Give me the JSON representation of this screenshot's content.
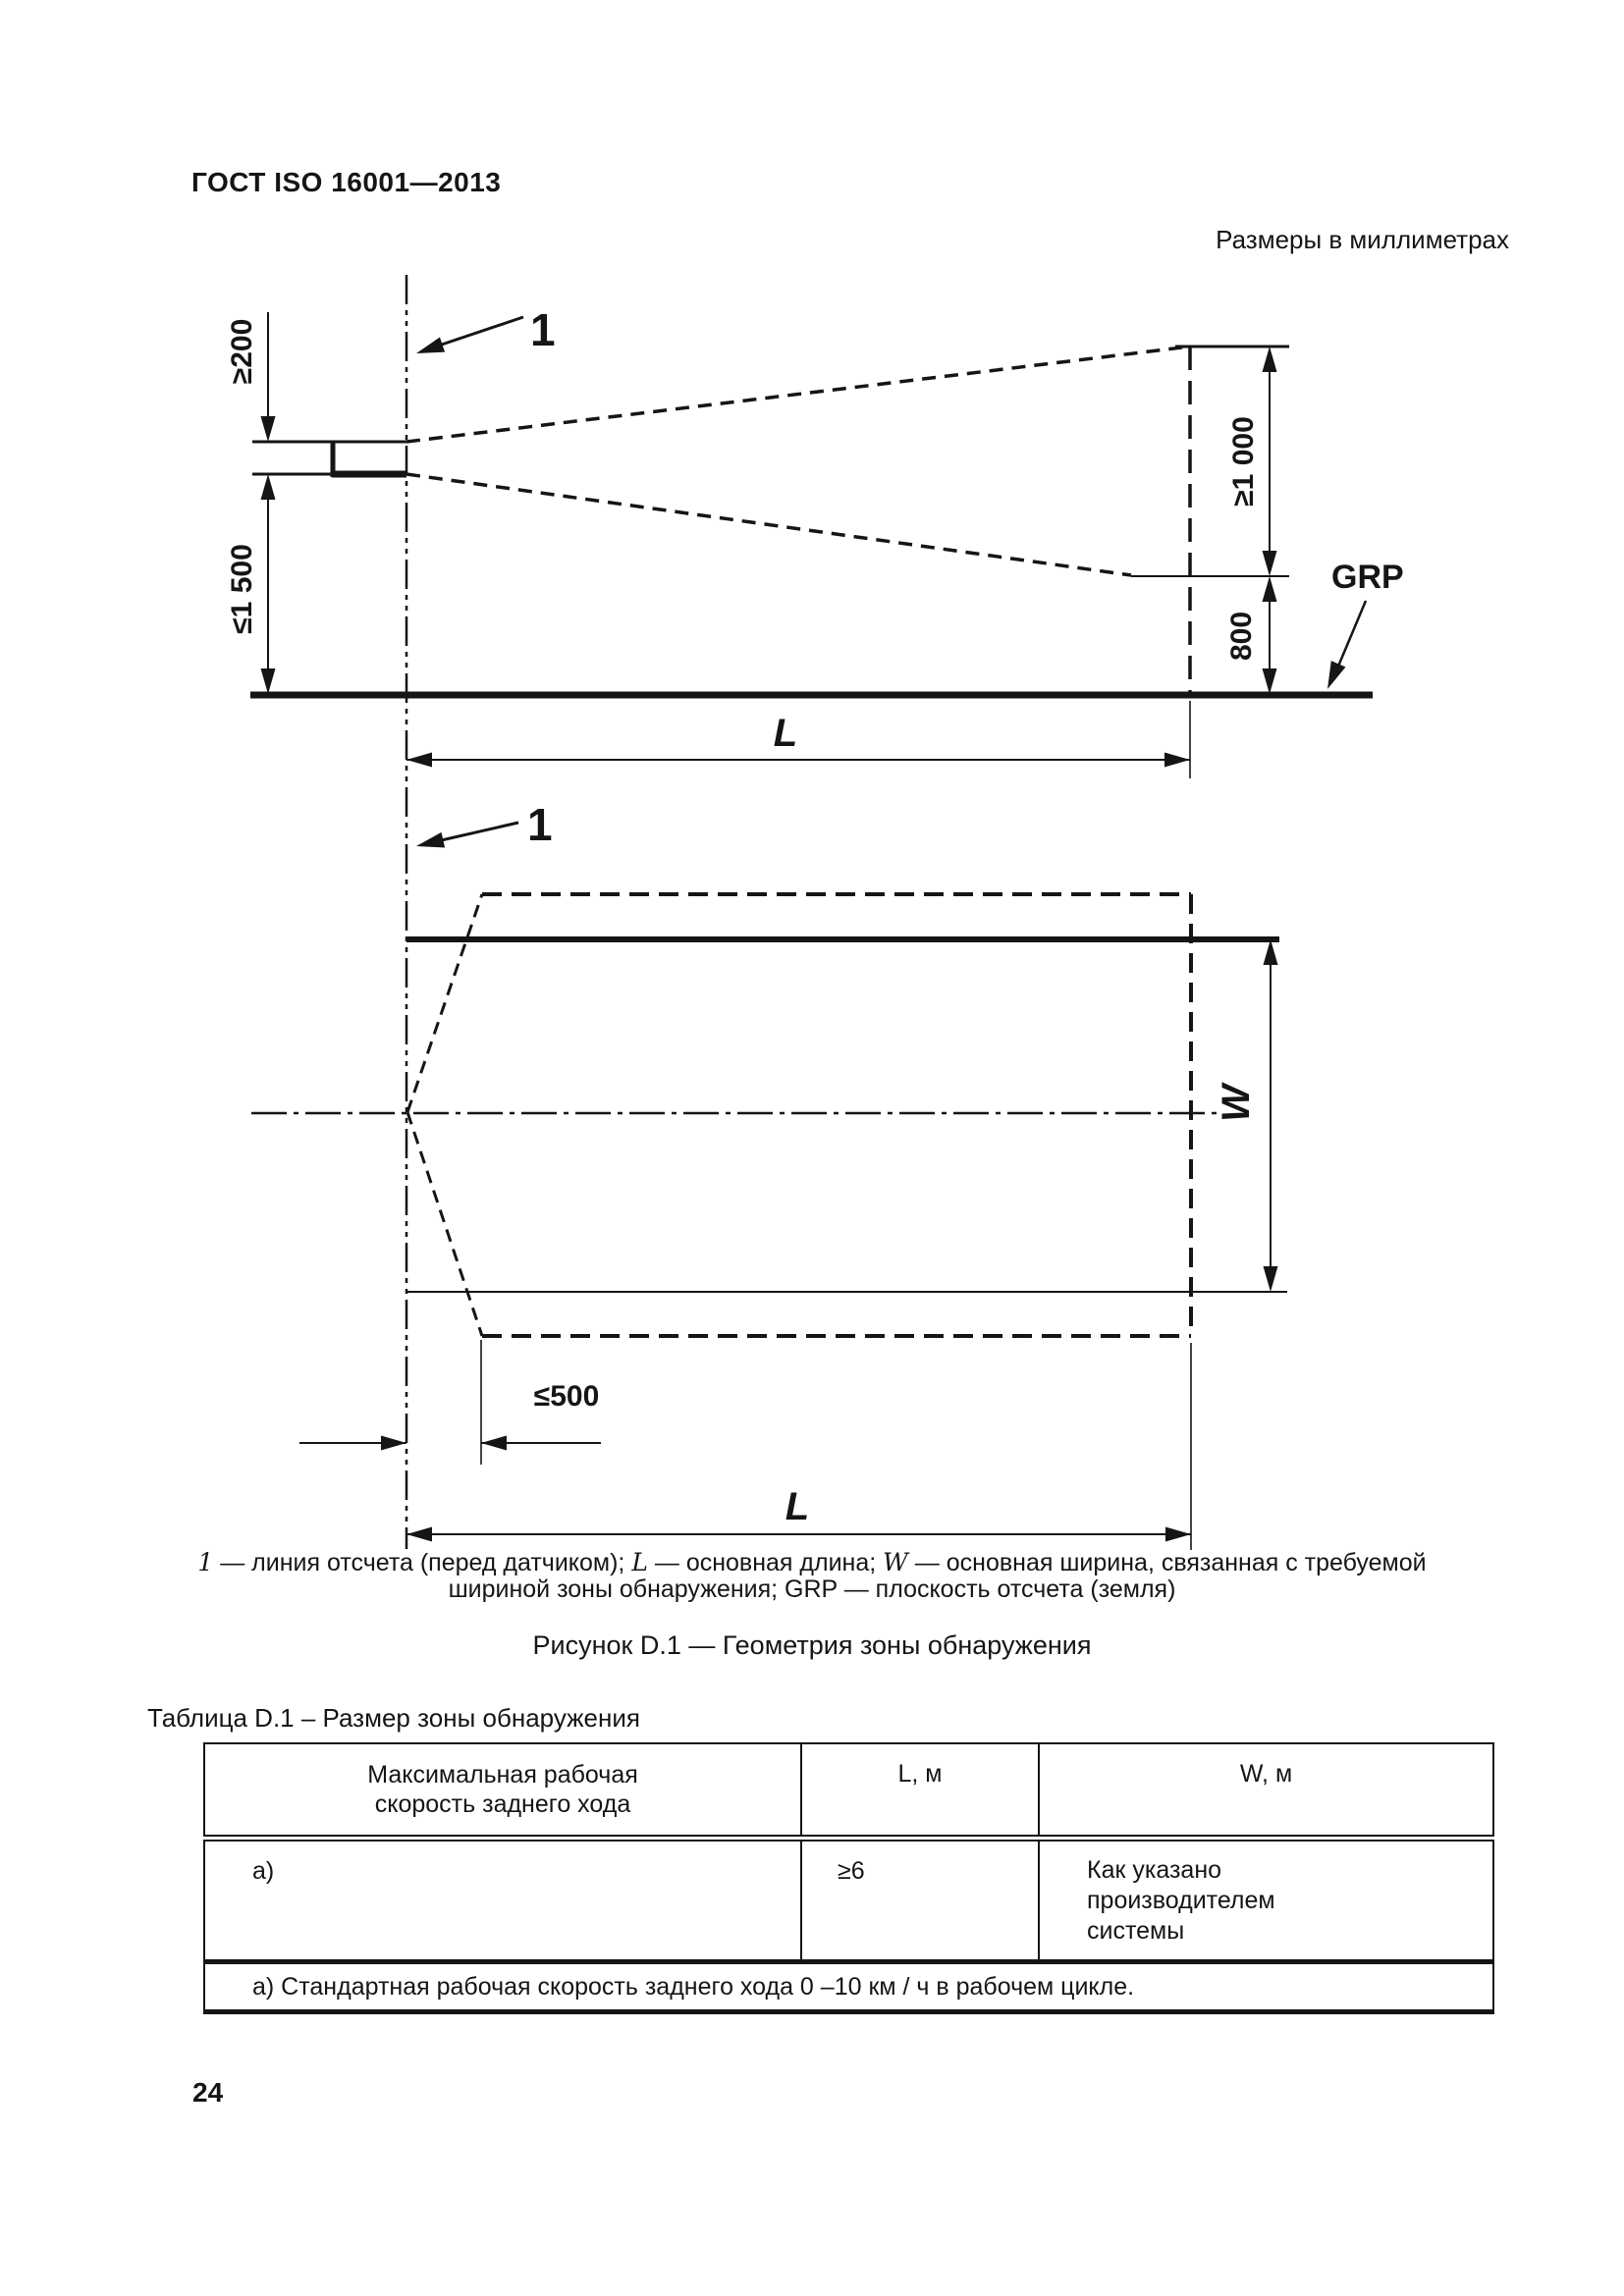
{
  "page": {
    "standard_code": "ГОСТ ISO 16001—2013",
    "units_note": "Размеры в миллиметрах",
    "page_number": "24"
  },
  "figure": {
    "callout_1": "1",
    "grp": "GRP",
    "dim_200": "≥200",
    "dim_1500": "≤1 500",
    "dim_1000": "≥1 000",
    "dim_800": "800",
    "dim_500": "≤500",
    "dim_length": "L",
    "dim_width": "W",
    "caption": {
      "k1": "1",
      "t1": " — линия отсчета (перед датчиком); ",
      "k2": "L",
      "t2": " — основная длина; ",
      "k3": "W",
      "t3": " — основная ширина, связанная с требуемой шириной зоны обнаружения; GRP — плоскость отсчета (земля)"
    },
    "title": "Рисунок D.1 — Геометрия зоны обнаружения"
  },
  "table": {
    "caption": "Таблица D.1 – Размер зоны обнаружения",
    "header": {
      "col1": "Максимальная рабочая скорость заднего хода",
      "col2": "L, м",
      "col3": "W, м"
    },
    "row": {
      "col1": "а)",
      "col2": "≥6",
      "col3": "Как указано производителем системы"
    },
    "footnote": "а) Стандартная рабочая скорость заднего хода 0 –10 км / ч в рабочем цикле."
  }
}
